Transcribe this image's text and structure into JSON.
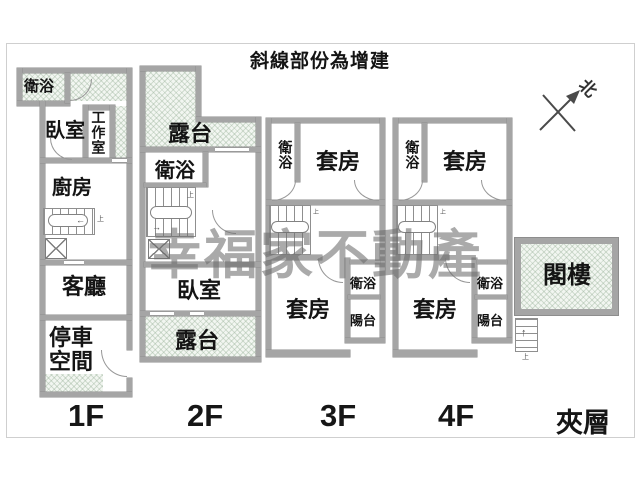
{
  "title": "斜線部份為增建",
  "compass": {
    "north": "北"
  },
  "watermark": "幸福家不動產",
  "floor_labels": {
    "f1": "1F",
    "f2": "2F",
    "f3": "3F",
    "f4": "4F",
    "mezzanine": "夾層"
  },
  "rooms": {
    "f1": {
      "bath": "衛浴",
      "bedroom": "臥室",
      "workroom": "工作室",
      "kitchen": "廚房",
      "living": "客廳",
      "parking": "停車空間"
    },
    "f2": {
      "terrace_top": "露台",
      "bath": "衛浴",
      "bedroom": "臥室",
      "terrace_bottom": "露台"
    },
    "f3": {
      "bath_top": "衛浴",
      "suite_top": "套房",
      "suite_bottom": "套房",
      "bath_bottom": "衛浴",
      "balcony": "陽台"
    },
    "f4": {
      "bath_top": "衛浴",
      "suite_top": "套房",
      "suite_bottom": "套房",
      "bath_bottom": "衛浴",
      "balcony": "陽台"
    },
    "mezzanine": {
      "attic": "閣樓"
    }
  },
  "annotations": {
    "stairs_up": "上"
  },
  "icons": {
    "left_arrow": "←",
    "right_arrow": "→",
    "up_arrow": "↑"
  },
  "colors": {
    "wall": "#a5a5a5",
    "hatch_bg": "#f2f6f1",
    "hatch_line": "#c9d6c9",
    "watermark": "#6c6c6c",
    "text": "#141414"
  }
}
